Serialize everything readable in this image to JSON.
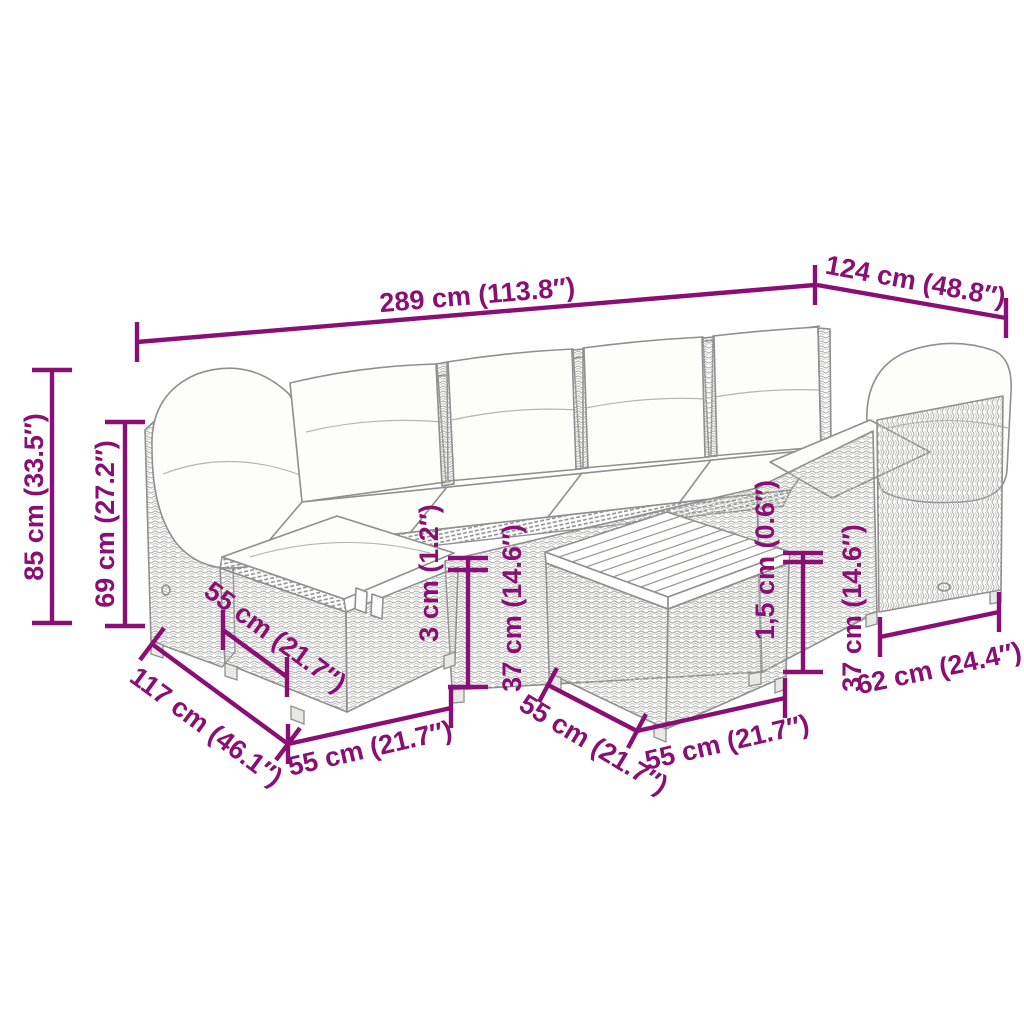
{
  "title": "Garden furniture set dimension diagram",
  "colors": {
    "dimension": "#8A0F74",
    "line_art": "#8f8f8f",
    "background": "#ffffff"
  },
  "dims": {
    "total_width": "289 cm (113.8″)",
    "corner_depth": "124 cm (48.8″)",
    "total_height": "85 cm (33.5″)",
    "back_height": "69 cm (27.2″)",
    "ottoman_side_depth": "55 cm (21.7″)",
    "diagonal_depth": "117 cm (46.1″)",
    "ottoman_front_width": "55 cm (21.7″)",
    "cushion_gap": "3 cm (1.2″)",
    "seat_height_left": "37 cm (14.6″)",
    "table_side_depth": "55 cm (21.7″)",
    "table_front_width": "55 cm (21.7″)",
    "panel_gap": "1,5 cm (0.6″)",
    "seat_height_right": "37 cm (14.6″)",
    "side_panel_depth": "62 cm (24.4″)"
  }
}
